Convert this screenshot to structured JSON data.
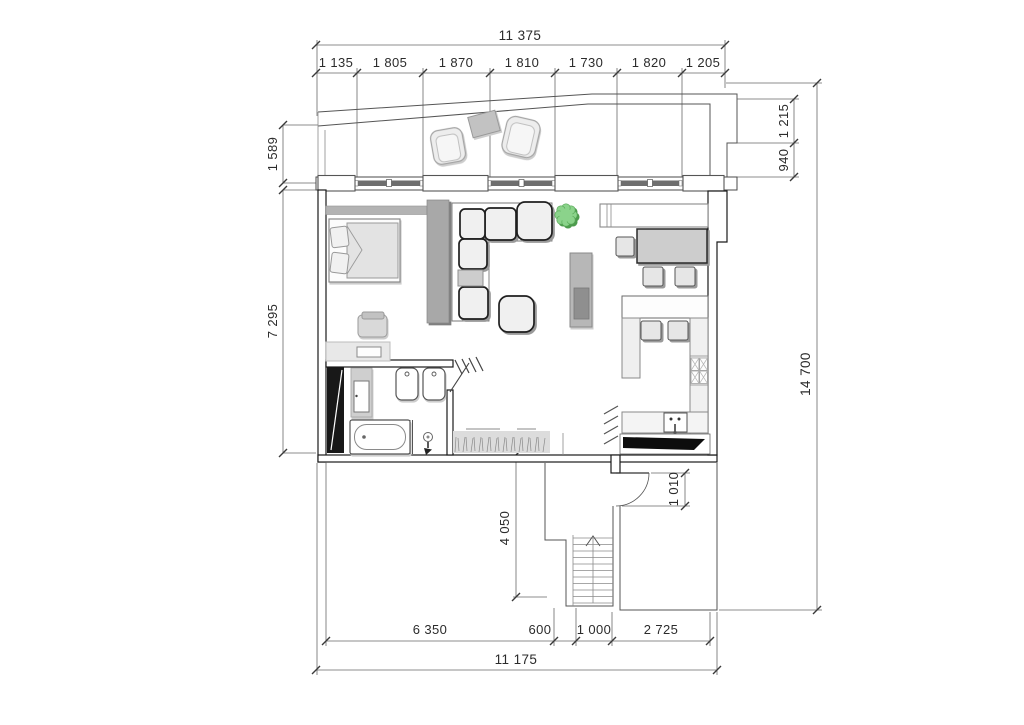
{
  "plan": {
    "kind": "architectural floor plan",
    "dims": {
      "top_total": "11 375",
      "top_segments": [
        "1 135",
        "1 805",
        "1 870",
        "1 810",
        "1 730",
        "1 820",
        "1 205"
      ],
      "left_segments": [
        "1 589",
        "7 295"
      ],
      "right_segments": [
        "1 215",
        "940"
      ],
      "right_total": "14 700",
      "inner_vertical": "4 050",
      "entry_opening": "1 010",
      "bottom_segments": [
        "6 350",
        "600",
        "1 000",
        "2 725"
      ],
      "bottom_total": "11 175"
    },
    "colors": {
      "wall_line": "#1a1a1a",
      "dimension_text": "#2b2b2b",
      "partition_gray": "#a8a8a8",
      "glazing_dark": "#6e6e6e",
      "plant_green": "#86cd86",
      "furniture_fill": "#f0f0f0",
      "background": "#ffffff"
    }
  }
}
